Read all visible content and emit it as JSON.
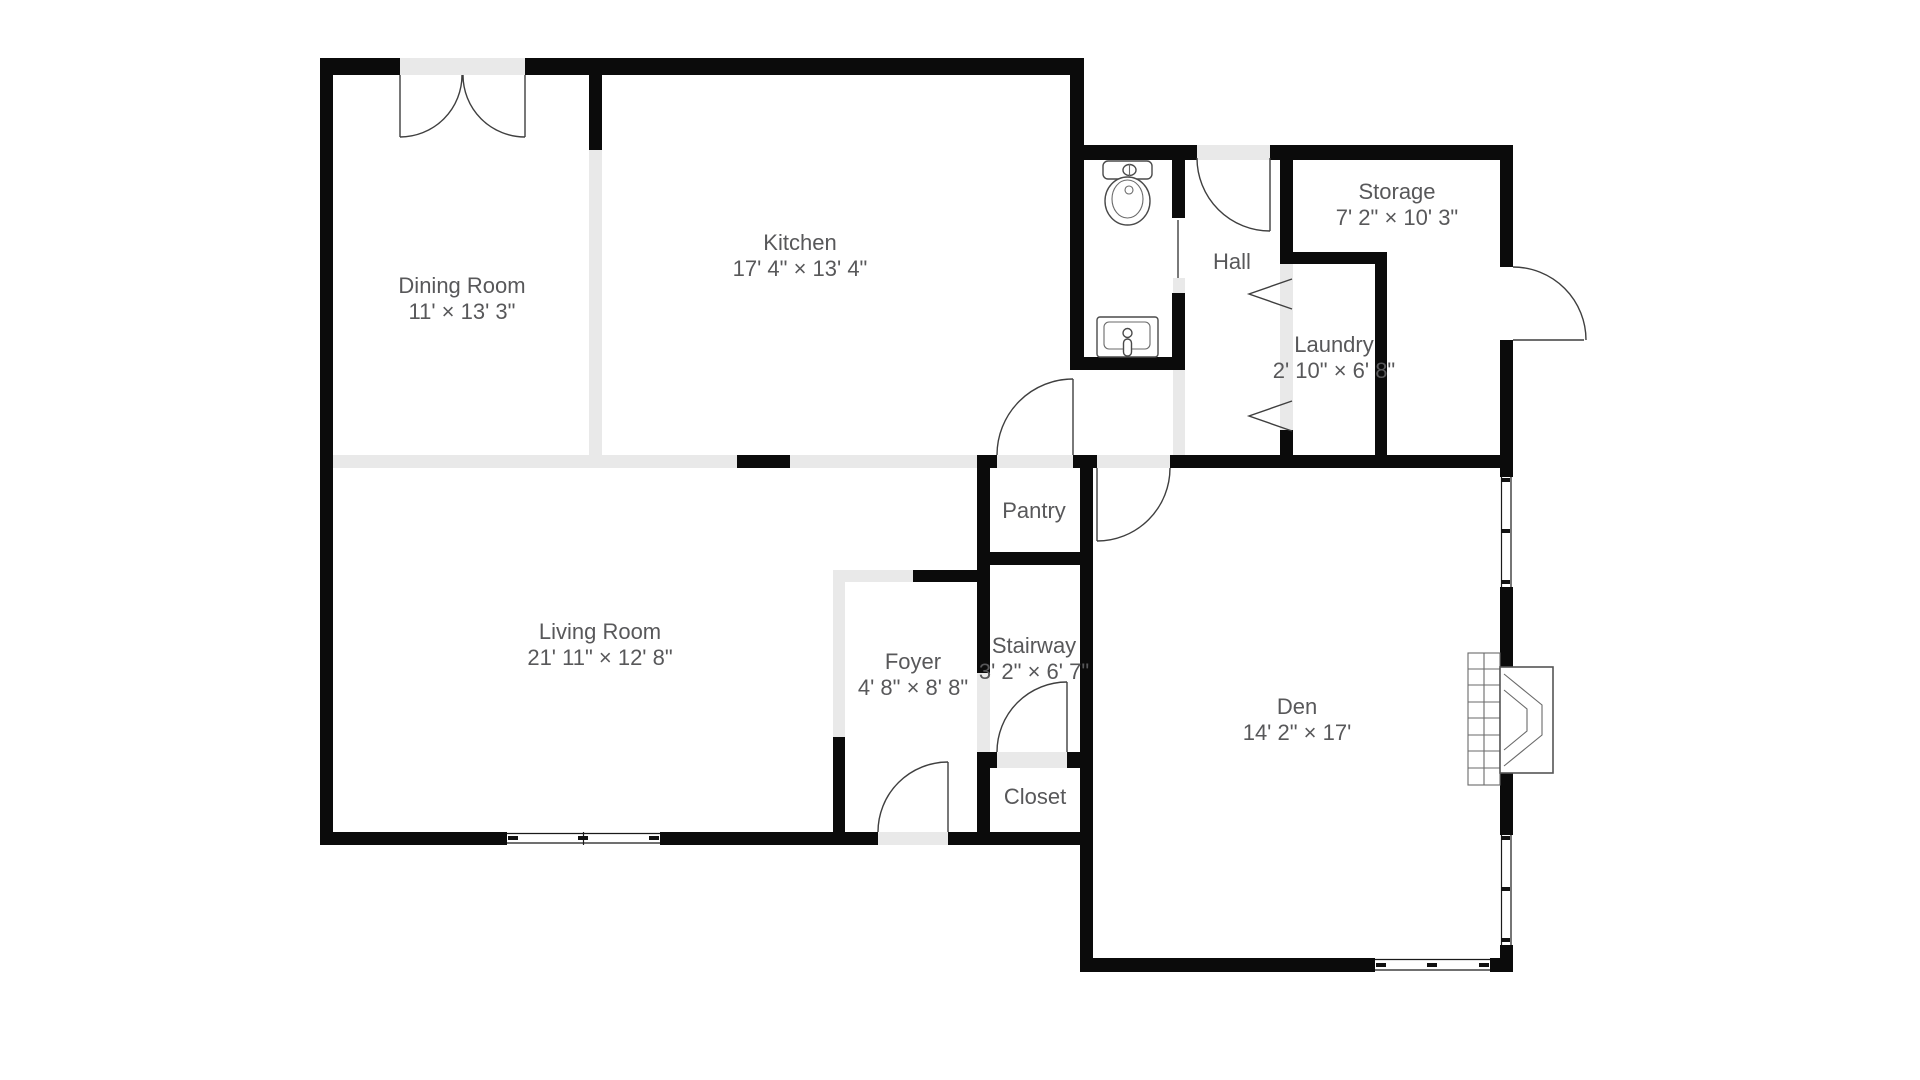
{
  "title": "Floor plan",
  "colors": {
    "background": "#ffffff",
    "wall": "#0b0b0b",
    "open_wall": "#e9e9e9",
    "label_text": "#58585a",
    "door_stroke": "#3f3f3f"
  },
  "floor_plan": {
    "rooms": [
      {
        "id": "dining",
        "name": "Dining Room",
        "dims": "11' × 13' 3\""
      },
      {
        "id": "kitchen",
        "name": "Kitchen",
        "dims": "17' 4\" × 13' 4\""
      },
      {
        "id": "living",
        "name": "Living Room",
        "dims": "21' 11\" × 12' 8\""
      },
      {
        "id": "den",
        "name": "Den",
        "dims": "14' 2\" × 17'"
      },
      {
        "id": "foyer",
        "name": "Foyer",
        "dims": "4' 8\" × 8' 8\""
      },
      {
        "id": "stairway",
        "name": "Stairway",
        "dims": "3' 2\" × 6' 7\""
      },
      {
        "id": "closet",
        "name": "Closet",
        "dims": ""
      },
      {
        "id": "pantry",
        "name": "Pantry",
        "dims": ""
      },
      {
        "id": "hall",
        "name": "Hall",
        "dims": ""
      },
      {
        "id": "storage",
        "name": "Storage",
        "dims": "7' 2\" × 10' 3\""
      },
      {
        "id": "laundry",
        "name": "Laundry",
        "dims": "2' 10\" × 6' 8\""
      }
    ],
    "fixtures": [
      "toilet",
      "sink",
      "fireplace",
      "double-door",
      "swing-doors",
      "bifold-doors",
      "windows"
    ]
  }
}
